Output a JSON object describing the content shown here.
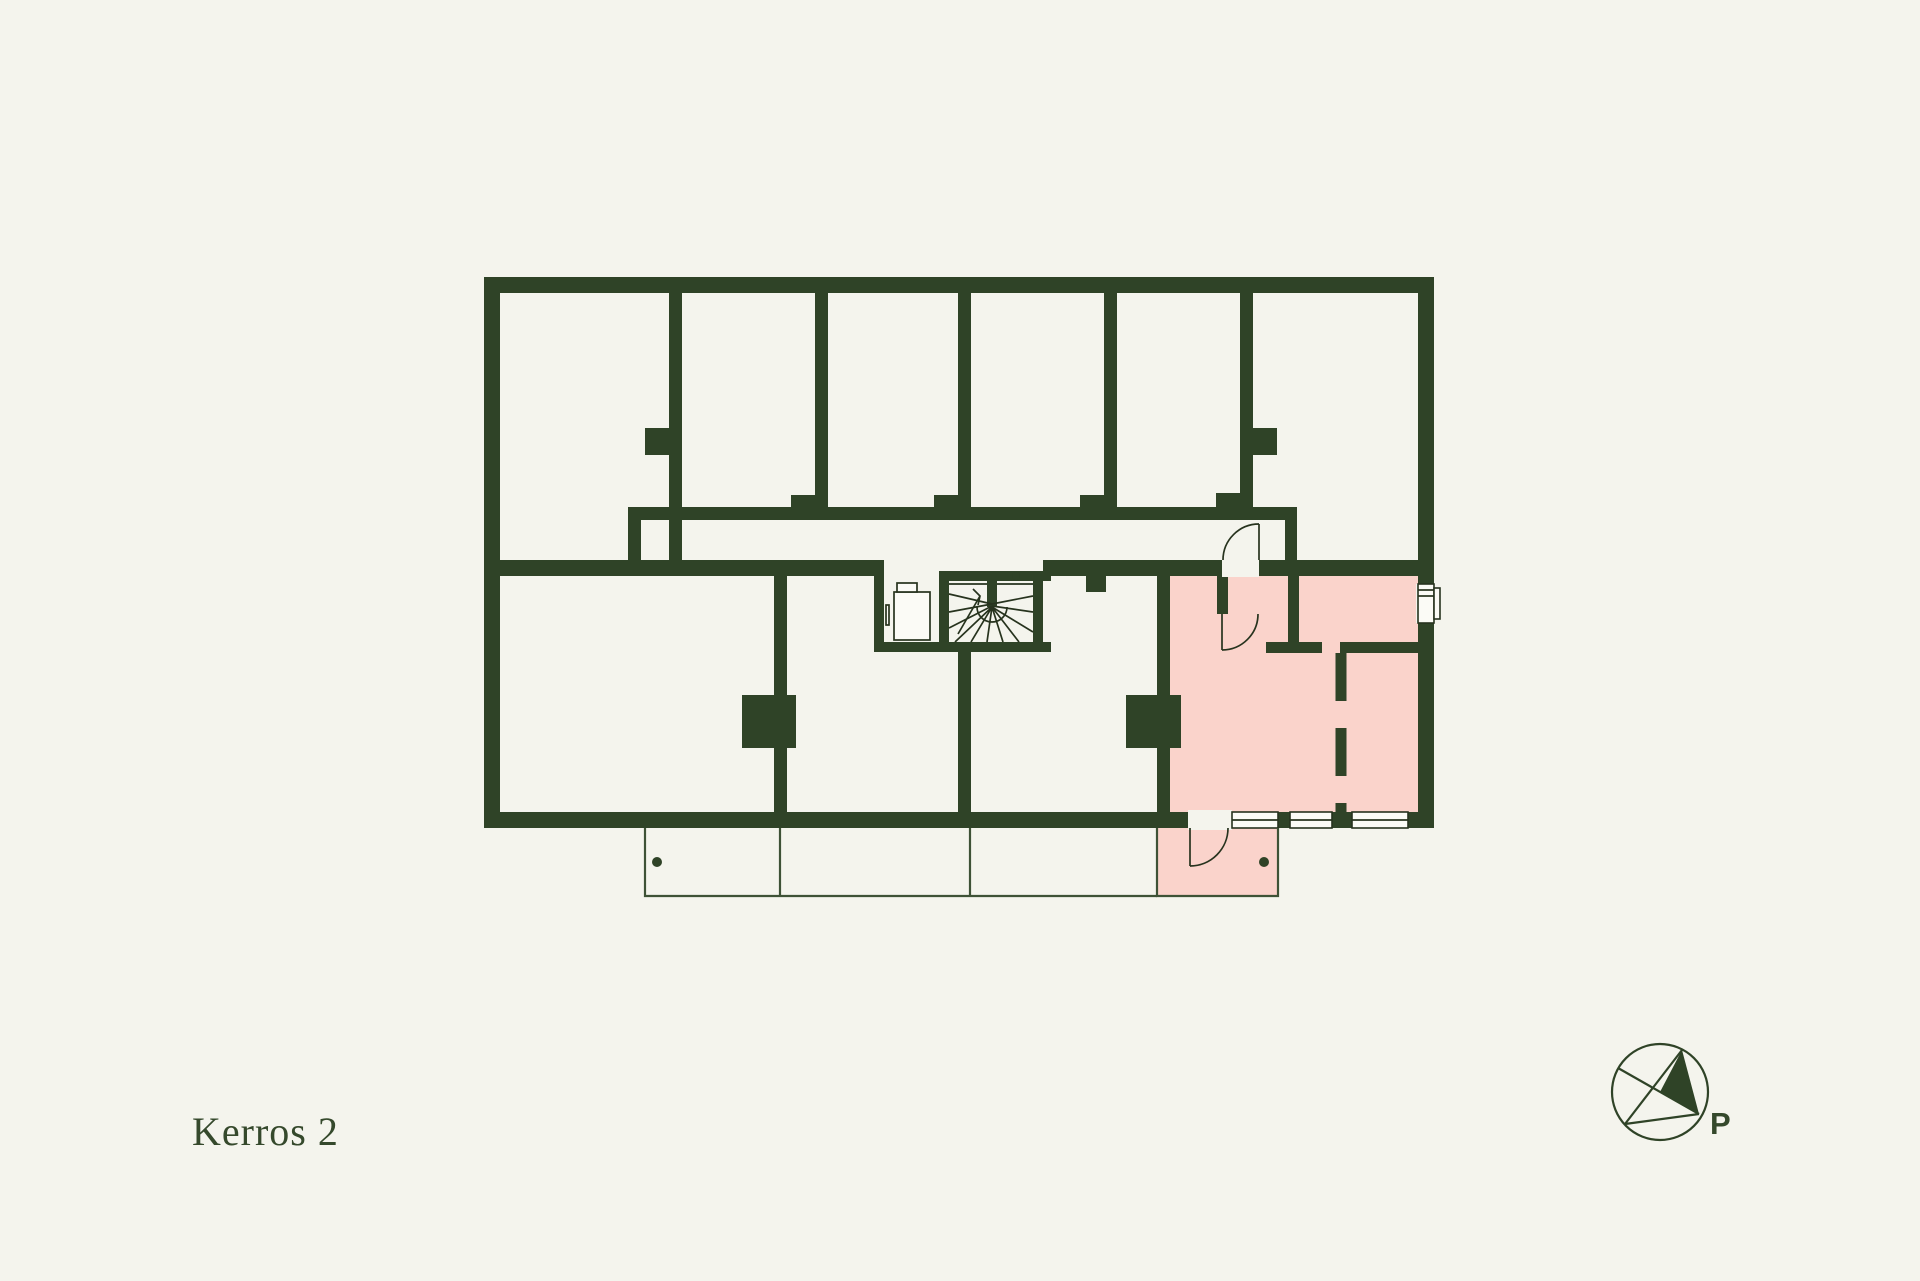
{
  "floor_label": "Kerros 2",
  "compass": {
    "label": "P"
  },
  "colors": {
    "background": "#f4f4ed",
    "wall": "#2f4327",
    "highlight": "#fad3cb",
    "detail_line": "#27331e",
    "balcony_line": "#3e5236",
    "text": "#35492c"
  },
  "plan": {
    "type": "apartment-floor-plan",
    "highlighted_unit_color": "#fad3cb",
    "top_storage_room_count": 6,
    "features": [
      "corridor",
      "elevator",
      "spiral-stair",
      "balcony-strip",
      "highlighted-apartment"
    ]
  }
}
